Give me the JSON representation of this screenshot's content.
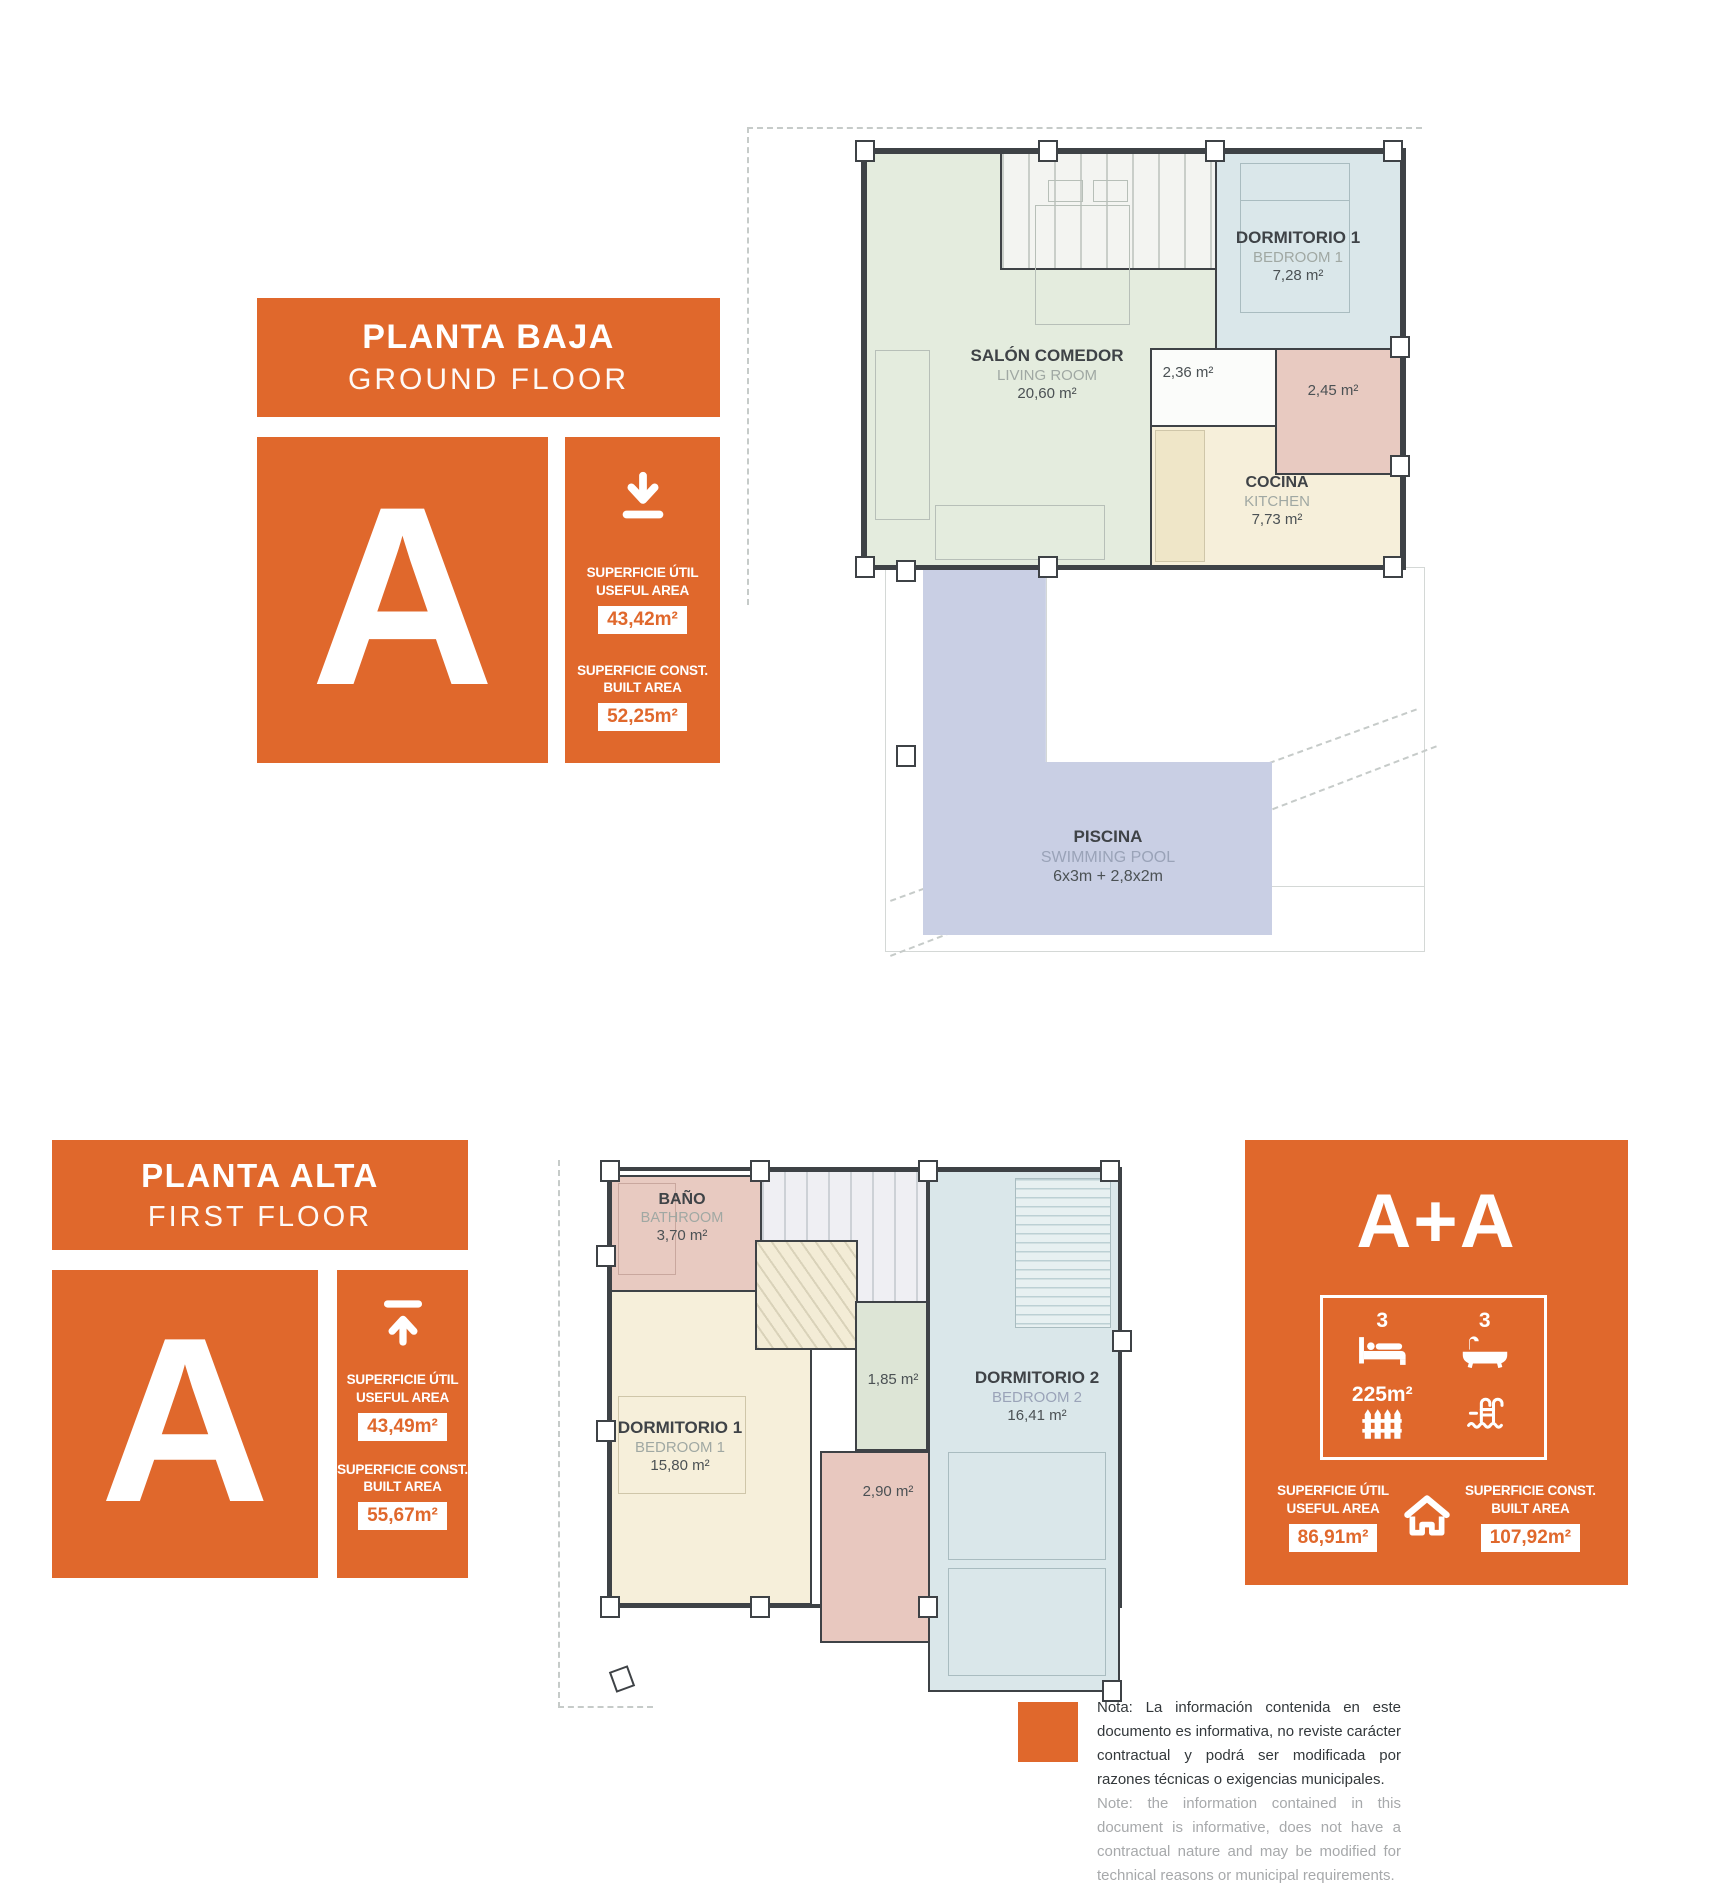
{
  "colors": {
    "accent": "#E0682C",
    "wall": "#3E4246",
    "pool": "#C9CFE4"
  },
  "ground_panel": {
    "title_es": "PLANTA BAJA",
    "title_en": "GROUND FLOOR",
    "letter": "A",
    "useful_es": "SUPERFICIE ÚTIL",
    "useful_en": "USEFUL AREA",
    "useful_val": "43,42m²",
    "built_es": "SUPERFICIE CONST.",
    "built_en": "BUILT AREA",
    "built_val": "52,25m²"
  },
  "first_panel": {
    "title_es": "PLANTA ALTA",
    "title_en": "FIRST FLOOR",
    "letter": "A",
    "useful_es": "SUPERFICIE ÚTIL",
    "useful_en": "USEFUL AREA",
    "useful_val": "43,49m²",
    "built_es": "SUPERFICIE CONST.",
    "built_en": "BUILT AREA",
    "built_val": "55,67m²"
  },
  "combo_panel": {
    "title": "A+A",
    "beds": "3",
    "baths": "3",
    "plot": "225m²",
    "useful_es": "SUPERFICIE ÚTIL",
    "useful_en": "USEFUL AREA",
    "useful_val": "86,91m²",
    "built_es": "SUPERFICIE CONST.",
    "built_en": "BUILT AREA",
    "built_val": "107,92m²"
  },
  "gf": {
    "living_es": "SALÓN COMEDOR",
    "living_en": "LIVING ROOM",
    "living_area": "20,60 m²",
    "bed1_es": "DORMITORIO 1",
    "bed1_en": "BEDROOM 1",
    "bed1_area": "7,28 m²",
    "hall_area": "2,36 m²",
    "bath_area": "2,45 m²",
    "kitchen_es": "COCINA",
    "kitchen_en": "KITCHEN",
    "kitchen_area": "7,73 m²",
    "pool_es": "PISCINA",
    "pool_en": "SWIMMING POOL",
    "pool_dims": "6x3m + 2,8x2m"
  },
  "ff": {
    "bath_es": "BAÑO",
    "bath_en": "BATHROOM",
    "bath_area": "3,70 m²",
    "bed1_es": "DORMITORIO 1",
    "bed1_en": "BEDROOM 1",
    "bed1_area": "15,80 m²",
    "landing_area": "1,85 m²",
    "bath2_area": "2,90 m²",
    "bed2_es": "DORMITORIO 2",
    "bed2_en": "BEDROOM 2",
    "bed2_area": "16,41 m²"
  },
  "note": {
    "es": "Nota: La información contenida en este documento es informativa, no reviste carácter contractual y podrá ser modificada por razones técnicas o exigencias municipales.",
    "en": "Note: the information contained in this document is informative, does not have a contractual nature and may be modified for technical reasons or municipal requirements."
  }
}
